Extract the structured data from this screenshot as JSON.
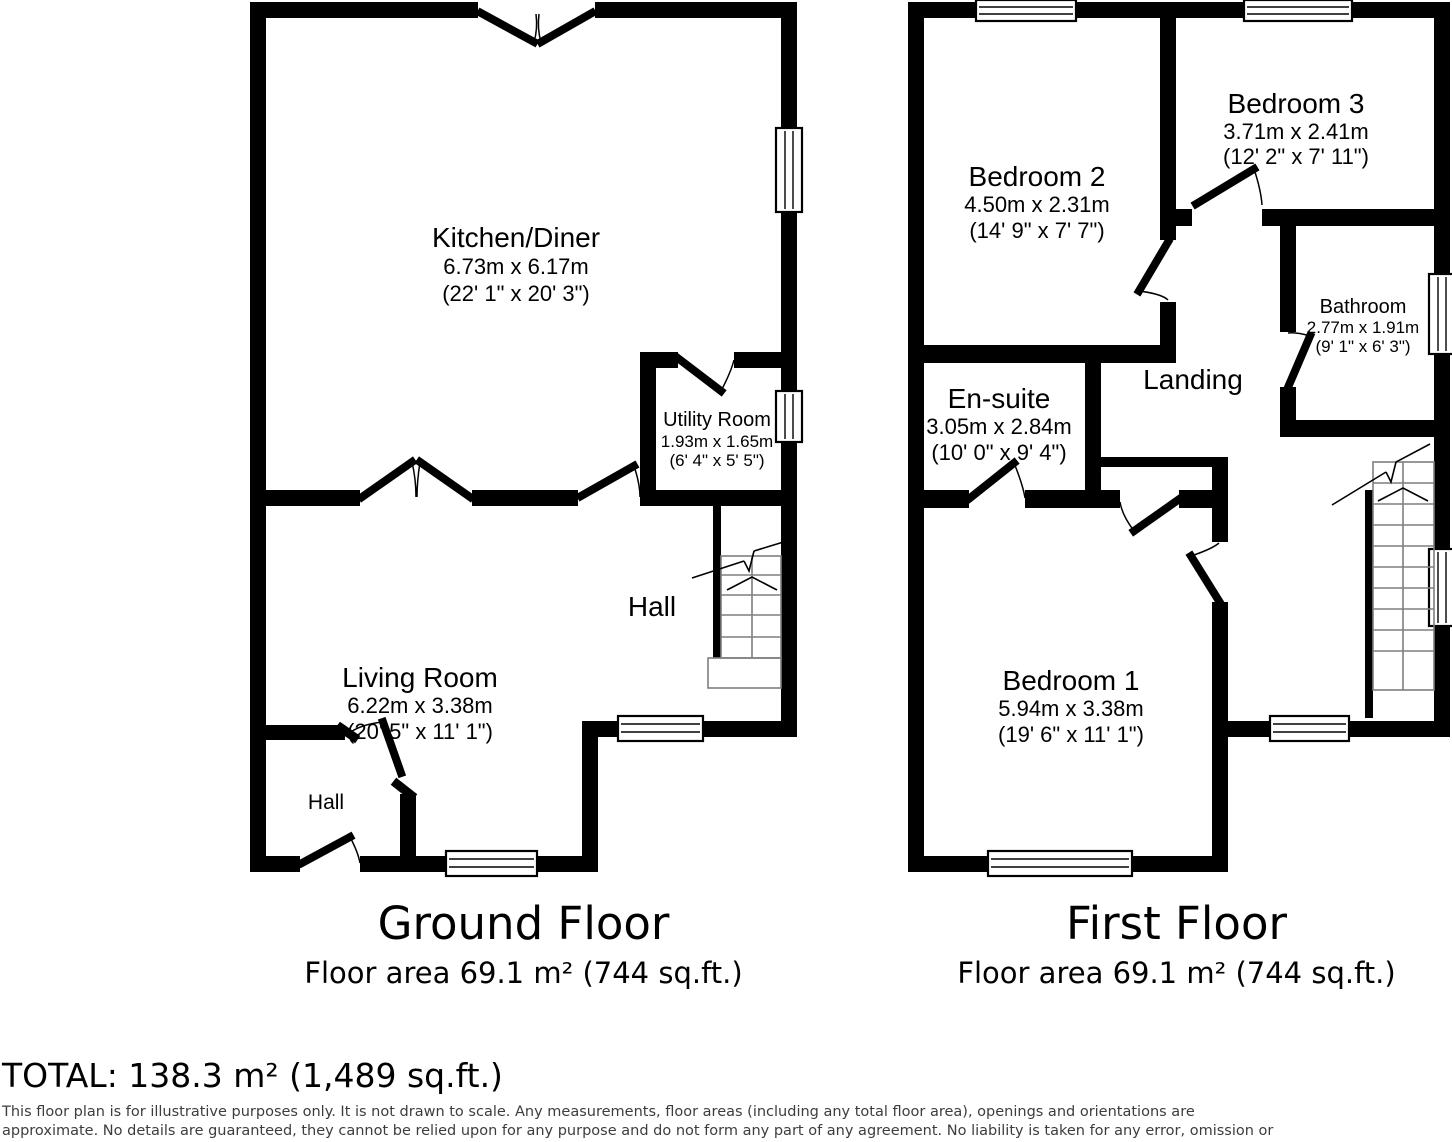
{
  "floors": {
    "ground": {
      "title": "Ground Floor",
      "area_label": "Floor area 69.1 m² (744 sq.ft.)",
      "rooms": {
        "kitchen_diner": {
          "name": "Kitchen/Diner",
          "metric": "6.73m x 6.17m",
          "imperial": "(22' 1\" x 20' 3\")"
        },
        "utility_room": {
          "name": "Utility Room",
          "metric": "1.93m x 1.65m",
          "imperial": "(6' 4\" x 5' 5\")"
        },
        "living_room": {
          "name": "Living Room",
          "metric": "6.22m x 3.38m",
          "imperial": "(20' 5\" x 11' 1\")"
        },
        "hall": {
          "name": "Hall"
        },
        "hall_small": {
          "name": "Hall"
        }
      }
    },
    "first": {
      "title": "First Floor",
      "area_label": "Floor area 69.1 m² (744 sq.ft.)",
      "rooms": {
        "bedroom_2": {
          "name": "Bedroom 2",
          "metric": "4.50m x 2.31m",
          "imperial": "(14' 9\" x 7' 7\")"
        },
        "bedroom_3": {
          "name": "Bedroom 3",
          "metric": "3.71m x 2.41m",
          "imperial": "(12' 2\" x 7' 11\")"
        },
        "bathroom": {
          "name": "Bathroom",
          "metric": "2.77m x 1.91m",
          "imperial": "(9' 1\" x 6' 3\")"
        },
        "en_suite": {
          "name": "En-suite",
          "metric": "3.05m x 2.84m",
          "imperial": "(10' 0\" x 9' 4\")"
        },
        "landing": {
          "name": "Landing"
        },
        "bedroom_1": {
          "name": "Bedroom 1",
          "metric": "5.94m x 3.38m",
          "imperial": "(19' 6\" x 11' 1\")"
        }
      }
    }
  },
  "total_label": "TOTAL: 138.3 m² (1,489 sq.ft.)",
  "disclaimer": {
    "line1": "This floor plan is for illustrative purposes only. It is not drawn to scale. Any measurements, floor areas (including any total floor area), openings and orientations are",
    "line2": "approximate. No details are guaranteed, they cannot be relied upon for any purpose and do not form any part of any agreement. No liability is taken for any error, omission or",
    "line3": "misstatement. A party must rely upon its own inspection(s). Powered by www.Propertybox.io"
  },
  "colors": {
    "wall": "#000000",
    "stair_line": "#7f7f7f",
    "text": "#000000",
    "disclaimer_text": "#3d3d3d"
  }
}
